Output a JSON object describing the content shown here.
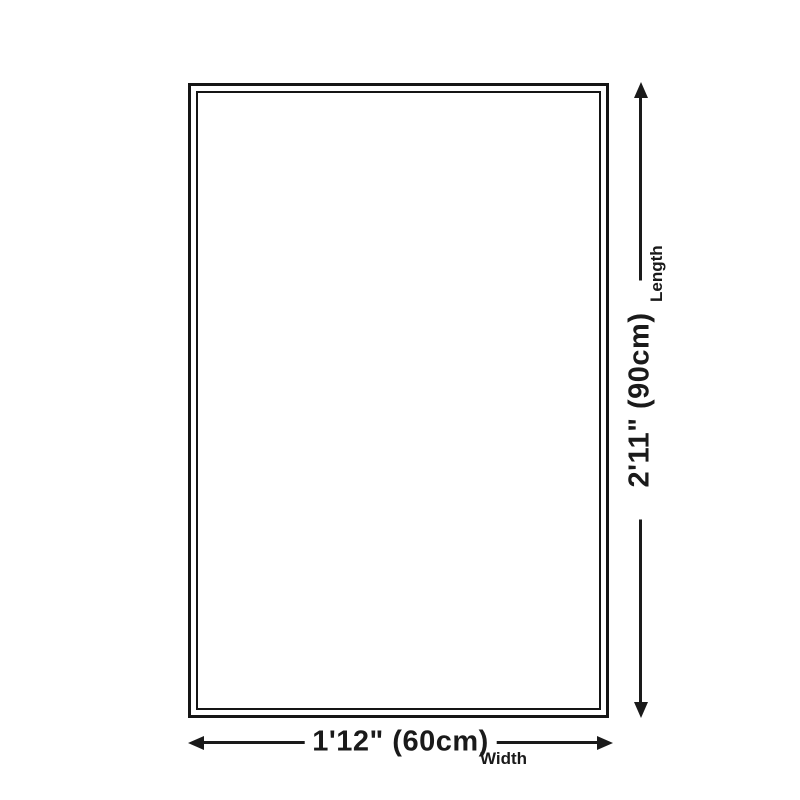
{
  "diagram": {
    "background_color": "#ffffff",
    "outline_color": "#151515",
    "line_color": "#1a1a1a",
    "text_color": "#1a1a1a",
    "dimensions": {
      "length": {
        "value": "2'11\" (90cm)",
        "label": "Length"
      },
      "width": {
        "value": "1'12\" (60cm)",
        "label": "Width"
      }
    }
  }
}
